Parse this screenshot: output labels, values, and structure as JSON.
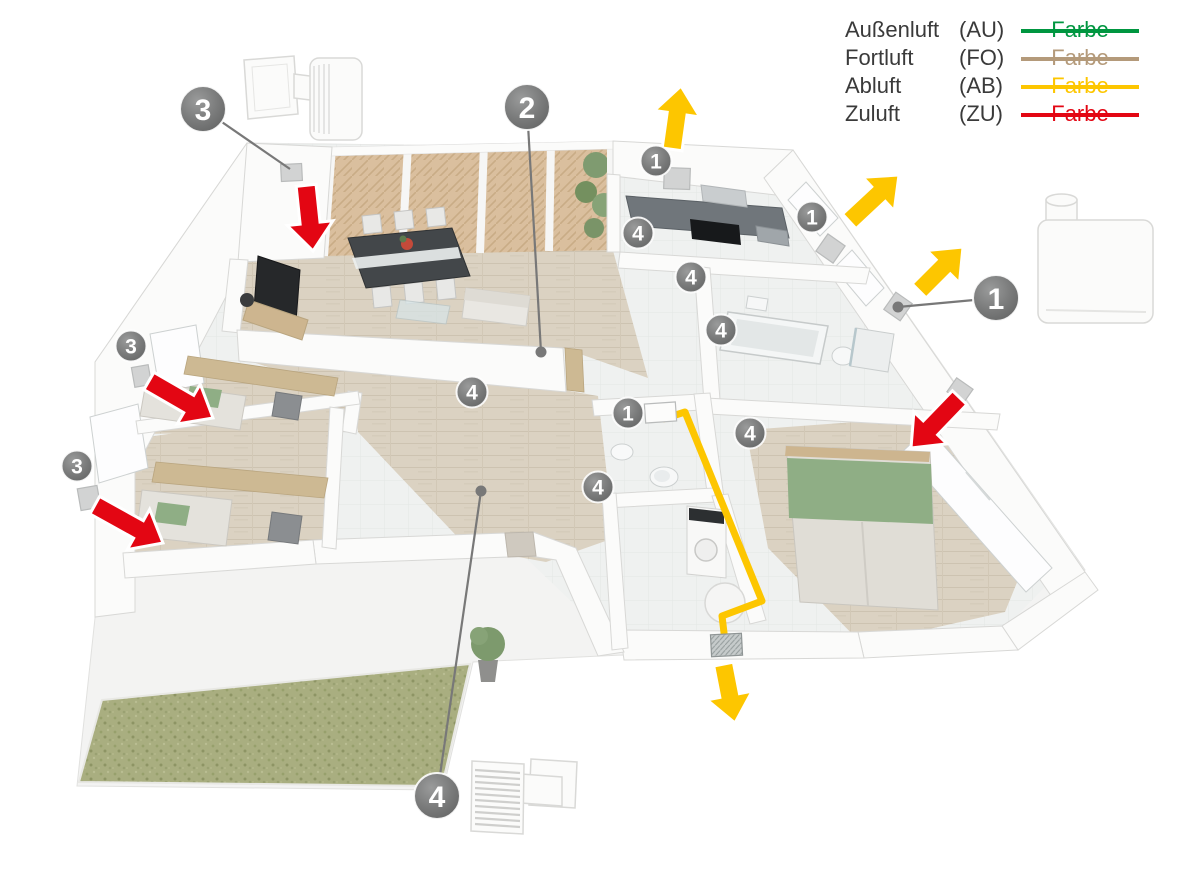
{
  "legend": {
    "swatch_label": "Farbe",
    "items": [
      {
        "label": "Außenluft",
        "code": "(AU)",
        "color": "#009640"
      },
      {
        "label": "Fortluft",
        "code": "(FO)",
        "color": "#b49a7a"
      },
      {
        "label": "Abluft",
        "code": "(AB)",
        "color": "#fdc600"
      },
      {
        "label": "Zuluft",
        "code": "(ZU)",
        "color": "#e30613"
      }
    ]
  },
  "colors": {
    "marker_gray": "#7a7b7b",
    "leader_gray": "#787878",
    "supply_red": "#e30613",
    "exhaust_yellow": "#fdc600"
  },
  "markers": {
    "large": [
      {
        "number": "3",
        "x": 203,
        "y": 109,
        "leader_to": {
          "x": 290,
          "y": 169
        },
        "dot": false
      },
      {
        "number": "2",
        "x": 527,
        "y": 107,
        "leader_to": {
          "x": 541,
          "y": 352
        },
        "dot": true
      },
      {
        "number": "1",
        "x": 996,
        "y": 298,
        "leader_to": {
          "x": 898,
          "y": 307
        },
        "dot": true
      },
      {
        "number": "4",
        "x": 437,
        "y": 796,
        "leader_to": {
          "x": 481,
          "y": 491
        },
        "dot": true
      }
    ],
    "small": [
      {
        "number": "3",
        "x": 131,
        "y": 346
      },
      {
        "number": "3",
        "x": 77,
        "y": 466
      },
      {
        "number": "1",
        "x": 656,
        "y": 161
      },
      {
        "number": "4",
        "x": 638,
        "y": 233
      },
      {
        "number": "4",
        "x": 691,
        "y": 277
      },
      {
        "number": "1",
        "x": 812,
        "y": 217
      },
      {
        "number": "4",
        "x": 721,
        "y": 330
      },
      {
        "number": "1",
        "x": 628,
        "y": 413
      },
      {
        "number": "4",
        "x": 750,
        "y": 433
      },
      {
        "number": "4",
        "x": 598,
        "y": 487
      },
      {
        "number": "4",
        "x": 472,
        "y": 392
      }
    ]
  },
  "arrows": [
    {
      "type": "zuluft-supply",
      "color": "#e30613",
      "tip_x": 313,
      "tip_y": 251,
      "angle": 174,
      "length": 66
    },
    {
      "type": "zuluft-supply",
      "color": "#e30613",
      "tip_x": 213,
      "tip_y": 418,
      "angle": 120,
      "length": 74
    },
    {
      "type": "zuluft-supply",
      "color": "#e30613",
      "tip_x": 163,
      "tip_y": 543,
      "angle": 119,
      "length": 78
    },
    {
      "type": "zuluft-supply",
      "color": "#e30613",
      "tip_x": 911,
      "tip_y": 448,
      "angle": 224,
      "length": 70
    },
    {
      "type": "abluft-exhaust",
      "color": "#fdc600",
      "tip_x": 681,
      "tip_y": 86,
      "angle": 8,
      "length": 64
    },
    {
      "type": "abluft-exhaust",
      "color": "#fdc600",
      "tip_x": 899,
      "tip_y": 175,
      "angle": 47,
      "length": 68
    },
    {
      "type": "abluft-exhaust",
      "color": "#fdc600",
      "tip_x": 963,
      "tip_y": 247,
      "angle": 45,
      "length": 62
    },
    {
      "type": "abluft-exhaust",
      "color": "#fdc600",
      "tip_x": 735,
      "tip_y": 723,
      "angle": 169,
      "length": 60
    }
  ],
  "duct": {
    "name": "abluft-duct",
    "color": "#fdc600",
    "path": [
      [
        663,
        419
      ],
      [
        685,
        412
      ],
      [
        762,
        601
      ],
      [
        722,
        616
      ],
      [
        725,
        641
      ]
    ]
  },
  "valves": [
    {
      "type": "supply-air-valve",
      "x": 281,
      "y": 164,
      "w": 21,
      "h": 17,
      "rot": -3
    },
    {
      "type": "supply-air-valve",
      "x": 133,
      "y": 366,
      "w": 17,
      "h": 20,
      "rot": -10
    },
    {
      "type": "supply-air-valve",
      "x": 79,
      "y": 487,
      "w": 20,
      "h": 22,
      "rot": -10
    },
    {
      "type": "supply-air-valve",
      "x": 950,
      "y": 382,
      "w": 20,
      "h": 17,
      "rot": 35
    },
    {
      "type": "exhaust-air-valve",
      "x": 664,
      "y": 168,
      "w": 26,
      "h": 21,
      "rot": 2
    },
    {
      "type": "exhaust-air-valve",
      "x": 820,
      "y": 238,
      "w": 21,
      "h": 21,
      "rot": 35
    },
    {
      "type": "exhaust-air-valve",
      "x": 888,
      "y": 296,
      "w": 20,
      "h": 21,
      "rot": 35
    },
    {
      "type": "ceiling-exhaust-valve",
      "x": 645,
      "y": 403,
      "w": 31,
      "h": 19,
      "rot": -4
    },
    {
      "type": "floor-grille",
      "x": 711,
      "y": 634,
      "w": 31,
      "h": 22,
      "rot": -3
    }
  ],
  "devices": [
    {
      "id": "device-wall-unit",
      "name": "decentral-wall-ventilation-unit"
    },
    {
      "id": "device-fan-box",
      "name": "exhaust-fan-unit"
    },
    {
      "id": "device-grille",
      "name": "outer-wall-transfer-grille"
    }
  ]
}
